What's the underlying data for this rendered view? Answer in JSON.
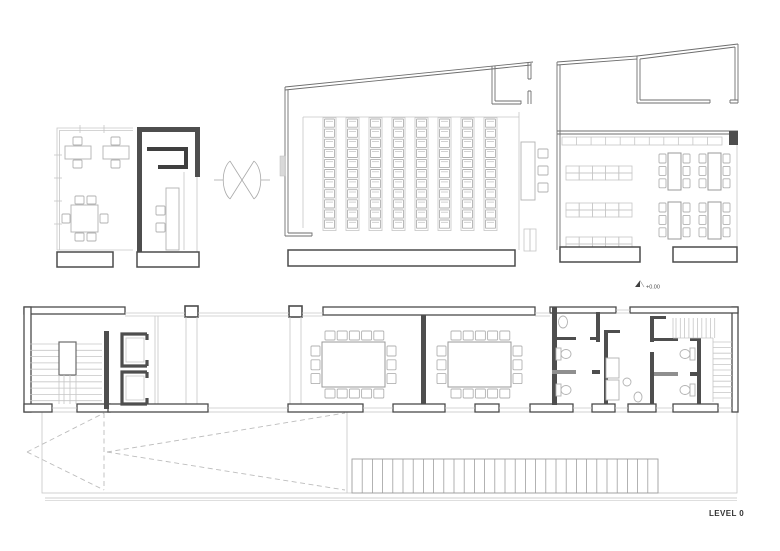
{
  "labels": {
    "level": "LEVEL 0",
    "elevation": "+0.00"
  },
  "palette": {
    "wall_dark": "#4e4e4e",
    "wall_outline": "#4b4b4b",
    "thin_wall": "#6e6e6e",
    "light_line": "#c6c6c6",
    "furniture": "#b2b2b2",
    "dash": "#bdbdbd",
    "text": "#333333"
  },
  "counts": {
    "auditorium_seat_columns": 8,
    "auditorium_seats_per_column": 11,
    "meeting_tables": 2,
    "meeting_chairs_top": 5,
    "meeting_chairs_bottom": 5,
    "meeting_chairs_side": 3,
    "classroom_tables": 4,
    "classroom_chairs_per_side": 3,
    "shelf_units": 3,
    "shelf_cols": 5,
    "shelf_rows": 2,
    "top_shelf_dividers": 10,
    "stair_treads_left": 10,
    "stair_treads_right_upper": 10,
    "stair_treads_right_lower": 11,
    "ramp_hatch_cells": 30
  }
}
